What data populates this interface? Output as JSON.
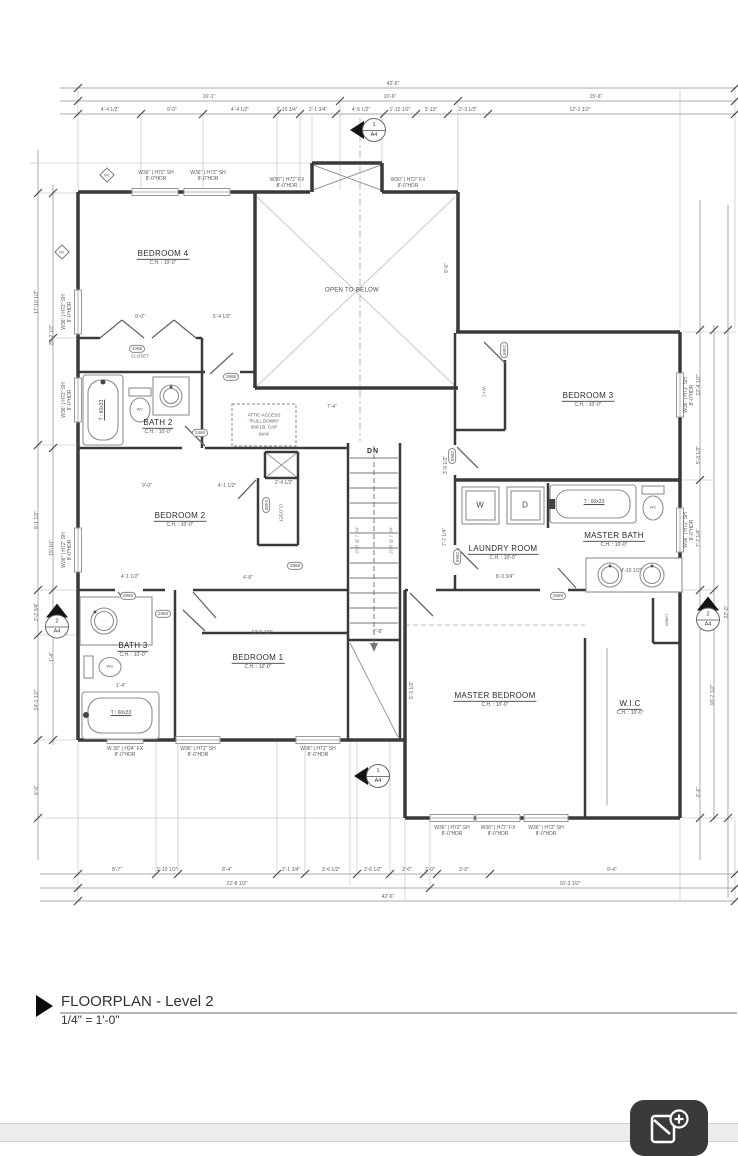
{
  "title_block": {
    "title": "FLOORPLAN - Level 2",
    "scale": "1/4\" = 1'-0\""
  },
  "colors": {
    "wall": "#3a3a3a",
    "dim_line": "#ababab",
    "fab_bg": "#3a3a3c",
    "band": "#ececec"
  },
  "icons": {
    "fab": "photo-plus-icon",
    "section_marker": "section-cut-marker",
    "title_marker": "triangle-marker"
  },
  "rooms": [
    {
      "name": "BEDROOM 4",
      "ch": "C.H. : 10'-0\"",
      "x": 163,
      "y": 258
    },
    {
      "name": "BEDROOM 3",
      "ch": "C.H. : 10'-0\"",
      "x": 588,
      "y": 400
    },
    {
      "name": "BATH 2",
      "ch": "C.H. : 10'-0\"",
      "x": 158,
      "y": 427
    },
    {
      "name": "BEDROOM 2",
      "ch": "C.H. : 10'-0\"",
      "x": 180,
      "y": 520
    },
    {
      "name": "LAUNDRY ROOM",
      "ch": "C.H. : 10'-0\"",
      "x": 503,
      "y": 553
    },
    {
      "name": "MASTER BATH",
      "ch": "C.H. : 10'-0\"",
      "x": 614,
      "y": 540
    },
    {
      "name": "BATH 3",
      "ch": "C.H. : 10'-0\"",
      "x": 133,
      "y": 650
    },
    {
      "name": "BEDROOM 1",
      "ch": "C.H. : 10'-0\"",
      "x": 258,
      "y": 662
    },
    {
      "name": "MASTER BEDROOM",
      "ch": "C.H. : 10'-0\"",
      "x": 495,
      "y": 700
    },
    {
      "name": "W.I.C",
      "ch": "C.H. : 10'-0\"",
      "x": 630,
      "y": 708
    }
  ],
  "labels": [
    {
      "t": "OPEN TO BELOW",
      "x": 352,
      "y": 291,
      "cls": "sm"
    },
    {
      "t": "CLOSET",
      "x": 140,
      "y": 356,
      "cls": "xs"
    },
    {
      "t": "CLOSET",
      "x": 281,
      "y": 513,
      "r": 90,
      "cls": "xs"
    },
    {
      "t": "W.I.C",
      "x": 484,
      "y": 392,
      "r": 90,
      "cls": "xs"
    },
    {
      "t": "LINEN",
      "x": 666,
      "y": 620,
      "r": 90,
      "cls": "xxs"
    },
    {
      "t": "DN",
      "x": 373,
      "y": 452,
      "cls": "dn"
    },
    {
      "t": "W",
      "x": 480,
      "y": 505,
      "cls": "wd"
    },
    {
      "t": "D",
      "x": 525,
      "y": 505,
      "cls": "wd"
    },
    {
      "t": "WC",
      "x": 140,
      "y": 410,
      "cls": "xxs"
    },
    {
      "t": "WC",
      "x": 110,
      "y": 667,
      "cls": "xxs"
    },
    {
      "t": "WC",
      "x": 653,
      "y": 508,
      "cls": "xxs"
    },
    {
      "t": "T : 60x33",
      "x": 103,
      "y": 410,
      "r": -90,
      "cls": "tub"
    },
    {
      "t": "T : 60x33",
      "x": 121,
      "y": 714,
      "cls": "tub"
    },
    {
      "t": "T : 60x33",
      "x": 594,
      "y": 503,
      "cls": "tub"
    },
    {
      "t": "16 R @ 7 3/4\"",
      "x": 357,
      "y": 540,
      "r": -90,
      "cls": "xs2"
    },
    {
      "t": "16 R @ 7 3/4\"",
      "x": 391,
      "y": 540,
      "r": -90,
      "cls": "xs2"
    },
    {
      "t": "ATTIC ACCESS\n\"PULL DOWN\"\n300 LB. CAP\nMAX",
      "x": 264,
      "y": 425,
      "cls": "attic"
    }
  ],
  "window_labels": [
    {
      "t": "W36\" | H72\" SH\n8'-0\"HDR",
      "x": 156,
      "y": 177
    },
    {
      "t": "W36\" | H72\" SH\n8'-0\"HDR",
      "x": 208,
      "y": 177
    },
    {
      "t": "W30\" | H72\" FX\n8'-0\"HDR",
      "x": 287,
      "y": 184
    },
    {
      "t": "W30\" | H72\" FX\n8'-0\"HDR",
      "x": 408,
      "y": 184
    },
    {
      "t": "W36\" | H72\" SH\n8'-0\"HDR",
      "x": 68,
      "y": 312,
      "r": -90
    },
    {
      "t": "W36\" | H72\" SH\n8'-0\"HDR",
      "x": 68,
      "y": 400,
      "r": -90
    },
    {
      "t": "W36\" | H72\" SH\n8'-0\"HDR",
      "x": 68,
      "y": 550,
      "r": -90
    },
    {
      "t": "W 30\" | H24\" FX\n8'-0\"HDR",
      "x": 125,
      "y": 753
    },
    {
      "t": "W36\" | H72\" SH\n8'-0\"HDR",
      "x": 198,
      "y": 753
    },
    {
      "t": "W36\" | H72\" SH\n8'-0\"HDR",
      "x": 318,
      "y": 753
    },
    {
      "t": "W36\" | H72\" SH\n8'-0\"HDR",
      "x": 452,
      "y": 832
    },
    {
      "t": "W30\" | H72\" FX\n8'-0\"HDR",
      "x": 498,
      "y": 832
    },
    {
      "t": "W36\" | H72\" SH\n8'-0\"HDR",
      "x": 546,
      "y": 832
    },
    {
      "t": "W36\" | H72\" SH\n8'-0\"HDR",
      "x": 690,
      "y": 395,
      "r": -90
    },
    {
      "t": "W36\" | H72\" SH\n8'-0\"HDR",
      "x": 690,
      "y": 530,
      "r": -90
    }
  ],
  "door_tags": [
    {
      "t": "4068",
      "x": 137,
      "y": 349
    },
    {
      "t": "2868",
      "x": 231,
      "y": 377
    },
    {
      "t": "2468",
      "x": 200,
      "y": 433
    },
    {
      "t": "2468",
      "x": 266,
      "y": 505,
      "r": 90
    },
    {
      "t": "2868",
      "x": 128,
      "y": 596
    },
    {
      "t": "2868",
      "x": 163,
      "y": 614
    },
    {
      "t": "2868",
      "x": 295,
      "y": 566
    },
    {
      "t": "2468",
      "x": 504,
      "y": 350,
      "r": 90
    },
    {
      "t": "2868",
      "x": 452,
      "y": 456,
      "r": 90
    },
    {
      "t": "2868",
      "x": 457,
      "y": 557,
      "r": 90
    },
    {
      "t": "2868",
      "x": 558,
      "y": 596
    }
  ],
  "interior_dims": [
    {
      "t": "9'-0\"",
      "x": 140,
      "y": 318
    },
    {
      "t": "5'-4 1/2\"",
      "x": 222,
      "y": 318
    },
    {
      "t": "7'-4\"",
      "x": 332,
      "y": 408
    },
    {
      "t": "7'-8\"",
      "x": 378,
      "y": 633
    },
    {
      "t": "9'-0\"",
      "x": 147,
      "y": 487
    },
    {
      "t": "4'-1 1/2\"",
      "x": 227,
      "y": 487
    },
    {
      "t": "2'-4 1/2\"",
      "x": 284,
      "y": 484
    },
    {
      "t": "4'-1 1/2\"",
      "x": 130,
      "y": 578
    },
    {
      "t": "4'-8\"",
      "x": 248,
      "y": 579
    },
    {
      "t": "12'-5 1/2\"",
      "x": 262,
      "y": 634
    },
    {
      "t": "8'-3 3/4\"",
      "x": 505,
      "y": 578
    },
    {
      "t": "4'-10 1/2\"",
      "x": 631,
      "y": 572
    },
    {
      "t": "1'-4\"",
      "x": 121,
      "y": 687
    },
    {
      "t": "9'-6\"",
      "x": 448,
      "y": 268,
      "r": -90
    },
    {
      "t": "3'-9 1/2\"",
      "x": 447,
      "y": 465,
      "r": -90
    },
    {
      "t": "7'-7 1/4\"",
      "x": 446,
      "y": 537,
      "r": -90
    },
    {
      "t": "5'-3 1/2\"",
      "x": 413,
      "y": 690,
      "r": -90
    }
  ],
  "dim_labels": [
    {
      "t": "42'-6\"",
      "x": 393,
      "y": 85
    },
    {
      "t": "16'-1\"",
      "x": 209,
      "y": 98
    },
    {
      "t": "10'-6\"",
      "x": 390,
      "y": 98
    },
    {
      "t": "15'-6\"",
      "x": 596,
      "y": 98
    },
    {
      "t": "4'-4 1/2\"",
      "x": 110,
      "y": 111
    },
    {
      "t": "9'-0\"",
      "x": 172,
      "y": 111
    },
    {
      "t": "4'-4 1/2\"",
      "x": 240,
      "y": 111
    },
    {
      "t": "1'-10 3/4\"",
      "x": 287,
      "y": 111
    },
    {
      "t": "2'-1 3/4\"",
      "x": 318,
      "y": 111
    },
    {
      "t": "4'-5 1/2\"",
      "x": 361,
      "y": 111
    },
    {
      "t": "1'-10 1/2\"",
      "x": 400,
      "y": 111
    },
    {
      "t": "3'-10\"",
      "x": 431,
      "y": 111
    },
    {
      "t": "2'-3 1/2\"",
      "x": 468,
      "y": 111
    },
    {
      "t": "12'-2 1/2\"",
      "x": 580,
      "y": 111
    },
    {
      "t": "8'-7\"",
      "x": 117,
      "y": 871
    },
    {
      "t": "1'-10 1/2\"",
      "x": 167,
      "y": 871
    },
    {
      "t": "8'-4\"",
      "x": 227,
      "y": 871
    },
    {
      "t": "2'-1 3/4\"",
      "x": 291,
      "y": 871
    },
    {
      "t": "3'-6 1/2\"",
      "x": 331,
      "y": 871
    },
    {
      "t": "3'-6 1/2\"",
      "x": 373,
      "y": 871
    },
    {
      "t": "2'-0\"",
      "x": 407,
      "y": 871
    },
    {
      "t": "2'-0\"",
      "x": 430,
      "y": 871
    },
    {
      "t": "3'-0\"",
      "x": 464,
      "y": 871
    },
    {
      "t": "9'-4\"",
      "x": 612,
      "y": 871
    },
    {
      "t": "22'-8 1/2\"",
      "x": 237,
      "y": 885
    },
    {
      "t": "16'-3 1/2\"",
      "x": 570,
      "y": 885
    },
    {
      "t": "42'-6\"",
      "x": 388,
      "y": 898
    },
    {
      "t": "17'-10 1/2\"",
      "x": 38,
      "y": 302,
      "r": -90
    },
    {
      "t": "20'-2 1/2\"",
      "x": 53,
      "y": 335,
      "r": -90
    },
    {
      "t": "9'-1 1/2\"",
      "x": 38,
      "y": 520,
      "r": -90
    },
    {
      "t": "15'-10\"",
      "x": 53,
      "y": 548,
      "r": -90
    },
    {
      "t": "2'-2 3/4\"",
      "x": 38,
      "y": 612,
      "r": -90
    },
    {
      "t": "1'-4\"",
      "x": 53,
      "y": 657,
      "r": -90
    },
    {
      "t": "14'-1 1/2\"",
      "x": 38,
      "y": 700,
      "r": -90
    },
    {
      "t": "6'-6\"",
      "x": 38,
      "y": 790,
      "r": -90
    },
    {
      "t": "12'-4 1/2\"",
      "x": 700,
      "y": 385,
      "r": -90
    },
    {
      "t": "5'-3 1/2\"",
      "x": 700,
      "y": 455,
      "r": -90
    },
    {
      "t": "7'-7 1/4\"",
      "x": 700,
      "y": 538,
      "r": -90
    },
    {
      "t": "22'-0\"",
      "x": 728,
      "y": 612,
      "r": -90
    },
    {
      "t": "16'-7 1/2\"",
      "x": 714,
      "y": 695,
      "r": -90
    },
    {
      "t": "6'-6\"",
      "x": 700,
      "y": 792,
      "r": -90
    }
  ],
  "sections": [
    {
      "n": "1",
      "s": "A4",
      "x": 368,
      "y": 130,
      "cls": "lt"
    },
    {
      "n": "1",
      "s": "A4",
      "x": 372,
      "y": 776,
      "cls": "lt"
    },
    {
      "n": "2",
      "s": "A4",
      "x": 57,
      "y": 621,
      "cls": "up"
    },
    {
      "n": "2",
      "s": "A4",
      "x": 708,
      "y": 614,
      "cls": "up"
    }
  ],
  "diamond_tags": [
    {
      "t": "W1",
      "x": 107,
      "y": 175
    },
    {
      "t": "W1",
      "x": 62,
      "y": 252
    }
  ]
}
